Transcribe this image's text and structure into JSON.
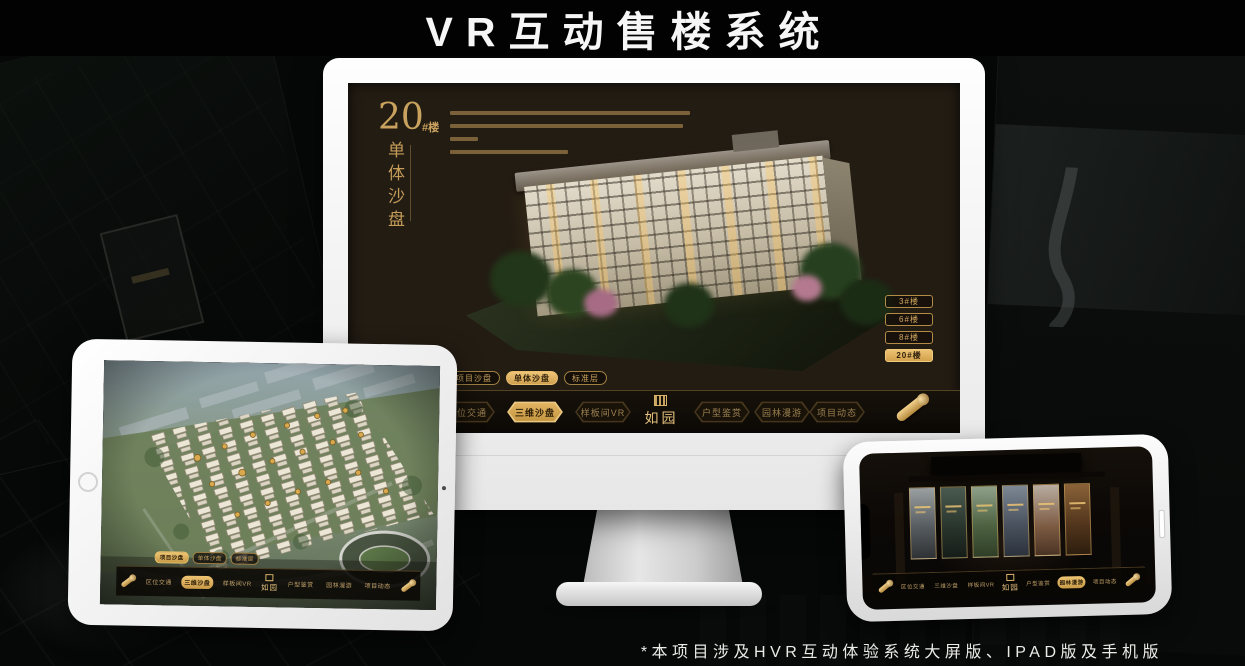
{
  "banner": {
    "title": "VR互动售楼系统"
  },
  "footnote": {
    "text": "*本项目涉及HVR互动体验系统大屏版、IPAD版及手机版"
  },
  "theme": {
    "gold": "#c9a25e",
    "gold_bright": "#e8bd6e",
    "screen_bg": "#231c13",
    "nav_bg": "#0d0a06",
    "device_frame": "#f4f4f4"
  },
  "monitor": {
    "headline": {
      "number": "20",
      "suffix": "#楼",
      "vertical_title": "单体沙盘"
    },
    "floor_buttons": [
      {
        "label": "3#楼",
        "active": false
      },
      {
        "label": "6#楼",
        "active": false
      },
      {
        "label": "8#楼",
        "active": false
      },
      {
        "label": "20#楼",
        "active": true
      }
    ],
    "view_tabs": [
      {
        "label": "项目沙盘",
        "active": false
      },
      {
        "label": "单体沙盘",
        "active": true
      },
      {
        "label": "标准层",
        "active": false
      }
    ],
    "nav": {
      "items_left": [
        {
          "label": "区位交通",
          "active": false
        },
        {
          "label": "三维沙盘",
          "active": true
        },
        {
          "label": "样板间VR",
          "active": false
        }
      ],
      "logo": "如园",
      "items_right": [
        {
          "label": "户型鉴赏",
          "active": false
        },
        {
          "label": "园林漫游",
          "active": false
        },
        {
          "label": "项目动态",
          "active": false
        }
      ]
    }
  },
  "tablet": {
    "view_tabs": [
      {
        "label": "项目沙盘",
        "active": true
      },
      {
        "label": "单体沙盘",
        "active": false
      },
      {
        "label": "标准层",
        "active": false
      }
    ],
    "nav": {
      "items_left": [
        {
          "label": "区位交通",
          "active": false
        },
        {
          "label": "三维沙盘",
          "active": true
        },
        {
          "label": "样板间VR",
          "active": false
        }
      ],
      "logo": "如园",
      "items_right": [
        {
          "label": "户型鉴赏",
          "active": false
        },
        {
          "label": "园林漫游",
          "active": false
        },
        {
          "label": "项目动态",
          "active": false
        }
      ]
    }
  },
  "phone": {
    "nav": {
      "items_left": [
        {
          "label": "区位交通",
          "active": false
        },
        {
          "label": "三维沙盘",
          "active": false
        },
        {
          "label": "样板间VR",
          "active": false
        }
      ],
      "logo": "如园",
      "items_right": [
        {
          "label": "户型鉴赏",
          "active": false
        },
        {
          "label": "园林漫游",
          "active": true
        },
        {
          "label": "项目动态",
          "active": false
        }
      ]
    },
    "gallery": {
      "card_count": 6,
      "card_tints": [
        "#8a8a82",
        "#2f4a3c",
        "#4f6b44",
        "#5d6f7e",
        "#9a8d84",
        "#6b4a2a"
      ]
    }
  }
}
